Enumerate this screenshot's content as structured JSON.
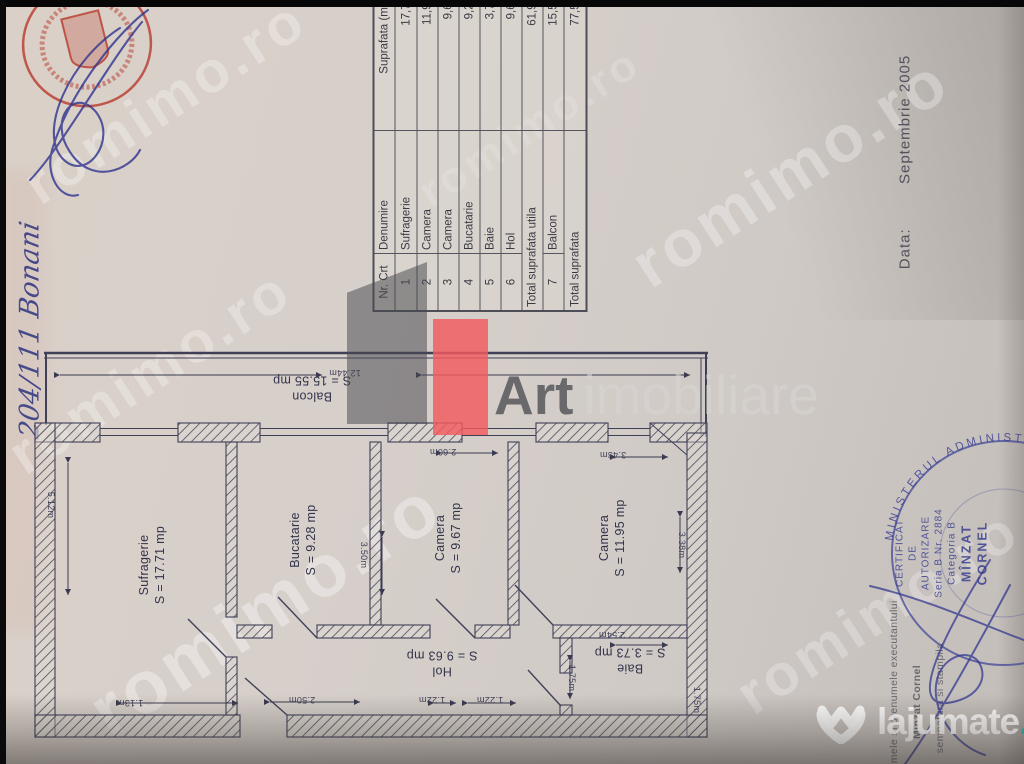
{
  "watermark": "romimo.ro",
  "handwriting": {
    "note": "204/111  Bonani"
  },
  "date": {
    "label": "Data:",
    "value": "Septembrie  2005"
  },
  "table": {
    "headers": {
      "nr": "Nr. Crt",
      "name": "Denumire",
      "area": "Suprafata (mp)"
    },
    "rows": [
      {
        "nr": "1",
        "name": "Sufragerie",
        "area": "17,71"
      },
      {
        "nr": "2",
        "name": "Camera",
        "area": "11,95"
      },
      {
        "nr": "3",
        "name": "Camera",
        "area": "9,67"
      },
      {
        "nr": "4",
        "name": "Bucatarie",
        "area": "9,28"
      },
      {
        "nr": "5",
        "name": "Baie",
        "area": "3,73"
      },
      {
        "nr": "6",
        "name": "Hol",
        "area": "9,63"
      },
      {
        "nr": "",
        "name": "Total suprafata utila",
        "area": "61,97"
      },
      {
        "nr": "7",
        "name": "Balcon",
        "area": "15,55"
      },
      {
        "nr": "",
        "name": "Total suprafata",
        "area": "77,52"
      }
    ]
  },
  "plan": {
    "rooms": [
      {
        "name": "Sufragerie",
        "area": "S = 17.71 mp"
      },
      {
        "name": "Bucatarie",
        "area": "S = 9.28 mp"
      },
      {
        "name": "Camera",
        "area": "S = 9.67 mp"
      },
      {
        "name": "Camera",
        "area": "S = 11.95 mp"
      },
      {
        "name": "Balcon",
        "area": "S = 15.55 mp"
      },
      {
        "name": "Hol",
        "area": "S = 9.63 mp"
      },
      {
        "name": "Baie",
        "area": "S = 3.73 mp"
      }
    ],
    "dims": {
      "balcony": "12.44m",
      "suf_h": "5.12m",
      "suf_b": "1.13m",
      "hol_w": "2.50m",
      "d122a": "1.22m",
      "d122b": "1.22m",
      "buc_h": "3.50m",
      "cam1_w": "2.60m",
      "cam2_w": "3.43m",
      "cam2_h": "3.38m",
      "baie_w": "2.54m",
      "baie_h": "1.75m",
      "hol_h": "1.75m"
    }
  },
  "stamp_blue": {
    "ring": "MINISTERUL  ADMINISTRATIEI  PUBLICE",
    "l1": "CERTIFICAT",
    "l2": "DE",
    "l3": "AUTORIZARE",
    "l4": "Seria B Nr. 2884",
    "l5": "Categoria B",
    "l6": "MÎNZAT",
    "l7": "CORNEL"
  },
  "footer": {
    "l1": "numele si prenumele executantului",
    "l2": "Minzat Cornel",
    "l3": "semnatura si stampila"
  },
  "logos": {
    "art": {
      "word1": "Art",
      "word2": "imobiliare",
      "accent": "#f25a5e"
    },
    "lajumate": {
      "word": "lajumate",
      "tld": ".ro",
      "accent": "#35b3ab"
    }
  }
}
